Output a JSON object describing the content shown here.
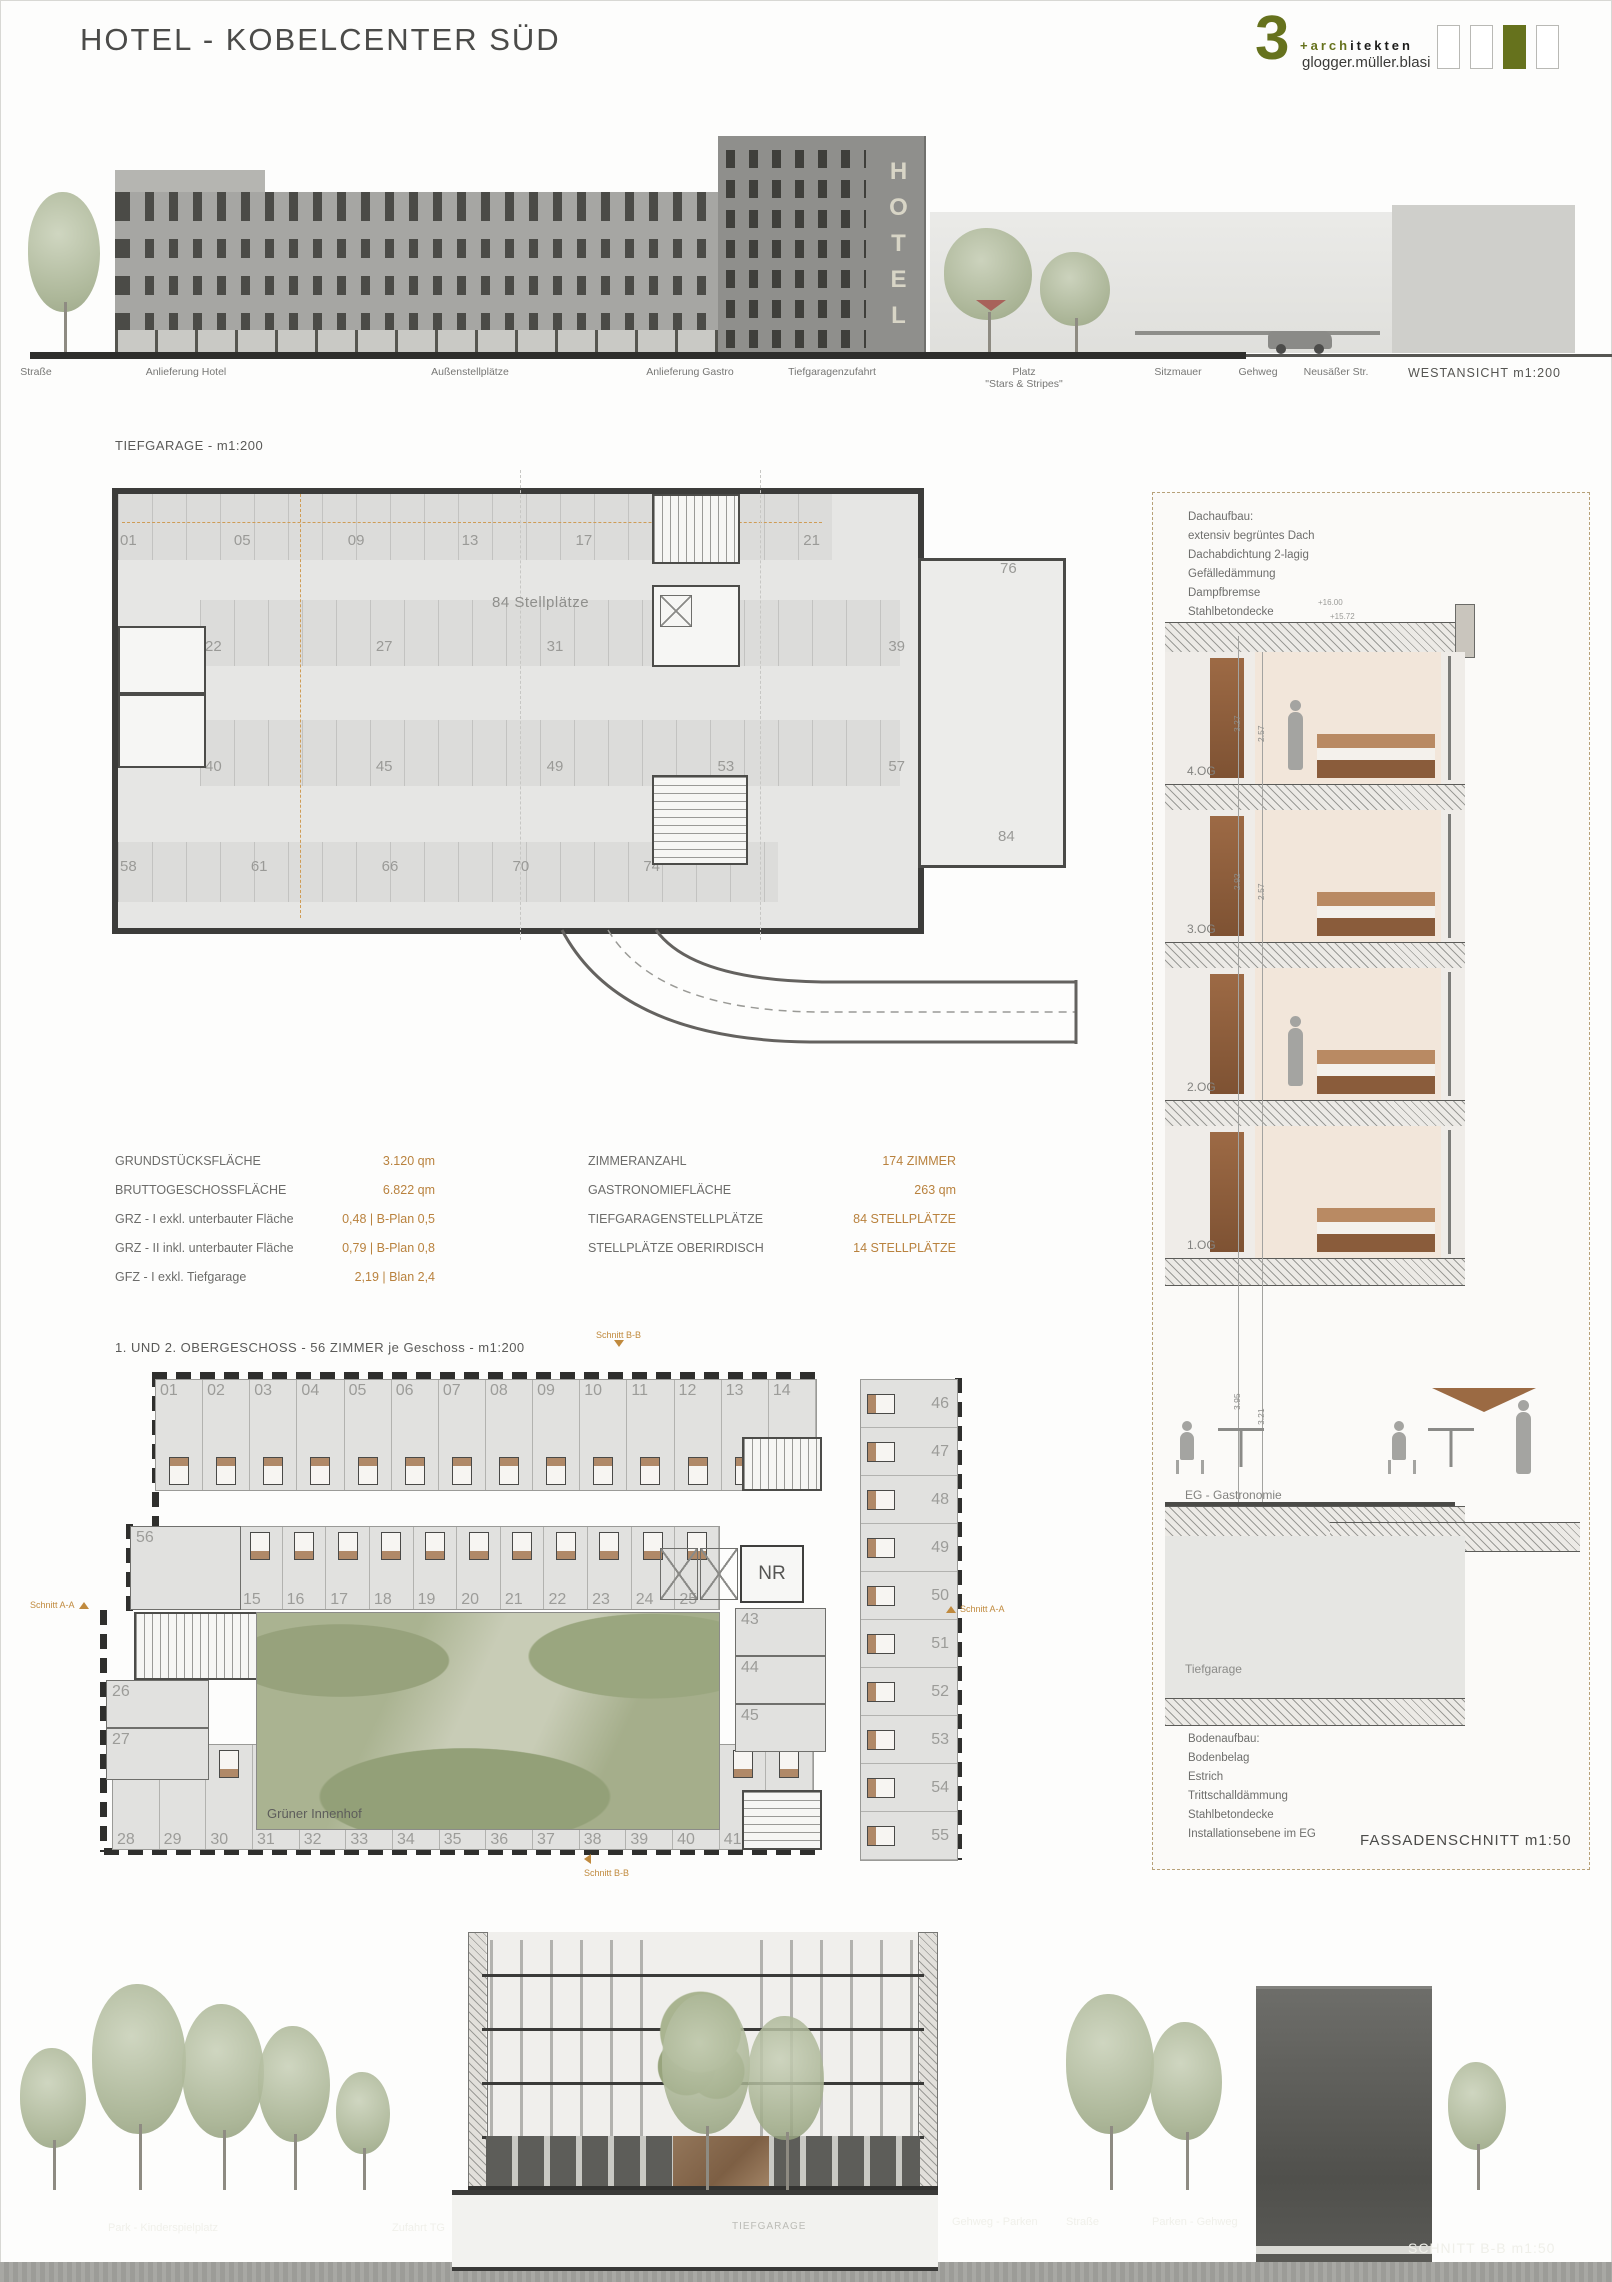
{
  "page": {
    "title": "HOTEL - KOBELCENTER SÜD"
  },
  "logo": {
    "number": "3",
    "accent": "+arch",
    "rest": "itekten",
    "subtitle": "glogger.müller.blasi",
    "olive_color": "#66721d"
  },
  "elevation": {
    "labels": [
      "Straße",
      "Anlieferung Hotel",
      "Außenstellplätze",
      "Anlieferung Gastro",
      "Tiefgaragenzufahrt",
      "Platz\n\"Stars & Stripes\"",
      "Sitzmauer",
      "Gehweg",
      "Neusäßer Str."
    ],
    "caption": "WESTANSICHT m1:200",
    "hotel_sign": "HOTEL"
  },
  "garage": {
    "title": "TIEFGARAGE - m1:200",
    "center_label": "84 Stellplätze",
    "row_top": [
      "01",
      "05",
      "09",
      "13",
      "17",
      "19",
      "21"
    ],
    "row2": [
      "22",
      "27",
      "31",
      "35",
      "39"
    ],
    "row3": [
      "40",
      "45",
      "49",
      "53",
      "57"
    ],
    "row4": [
      "58",
      "61",
      "66",
      "70",
      "74"
    ],
    "num_76": "76",
    "num_84": "84"
  },
  "stats": {
    "left": [
      {
        "label": "GRUNDSTÜCKSFLÄCHE",
        "value": "3.120 qm"
      },
      {
        "label": "BRUTTOGESCHOSSFLÄCHE",
        "value": "6.822 qm"
      },
      {
        "label": "GRZ - I exkl. unterbauter Fläche",
        "value": "0,48 | B-Plan 0,5"
      },
      {
        "label": "GRZ - II inkl. unterbauter Fläche",
        "value": "0,79 | B-Plan 0,8"
      },
      {
        "label": "GFZ - I exkl. Tiefgarage",
        "value": "2,19 | Blan 2,4"
      }
    ],
    "right": [
      {
        "label": "ZIMMERANZAHL",
        "value": "174 ZIMMER"
      },
      {
        "label": "GASTRONOMIEFLÄCHE",
        "value": "263 qm"
      },
      {
        "label": "TIEFGARAGENSTELLPLÄTZE",
        "value": "84 STELLPLÄTZE"
      },
      {
        "label": "STELLPLÄTZE OBERIRDISCH",
        "value": "14 STELLPLÄTZE"
      }
    ]
  },
  "floorplan": {
    "title": "1. UND 2. OBERGESCHOSS - 56 ZIMMER je Geschoss - m1:200",
    "courtyard_label": "Grüner Innenhof",
    "rooms_top": [
      "01",
      "02",
      "03",
      "04",
      "05",
      "06",
      "07",
      "08",
      "09",
      "10",
      "11",
      "12",
      "13",
      "14"
    ],
    "rooms_mid": [
      "15",
      "16",
      "17",
      "18",
      "19",
      "20",
      "21",
      "22",
      "23",
      "24",
      "25"
    ],
    "rooms_bottom": [
      "28",
      "29",
      "30",
      "31",
      "32",
      "33",
      "34",
      "35",
      "36",
      "37",
      "38",
      "39",
      "40",
      "41",
      "42"
    ],
    "rooms_right": [
      "46",
      "47",
      "48",
      "49",
      "50",
      "51",
      "52",
      "53",
      "54",
      "55"
    ],
    "room_56": "56",
    "room_26": "26",
    "room_27": "27",
    "room_43": "43",
    "room_44": "44",
    "room_45": "45",
    "nr_label": "NR",
    "section_bb": "Schnitt B-B",
    "section_aa": "Schnitt A-A"
  },
  "facade": {
    "roof_notes": [
      "Dachaufbau:",
      "extensiv begrüntes Dach",
      "Dachabdichtung 2-lagig",
      "Gefälledämmung",
      "Dampfbremse",
      "Stahlbetondecke"
    ],
    "floor_labels": [
      "4.OG",
      "3.OG",
      "2.OG",
      "1.OG"
    ],
    "eg_label": "EG - Gastronomie",
    "tg_label": "Tiefgarage",
    "floor_notes": [
      "Bodenaufbau:",
      "Bodenbelag",
      "Estrich",
      "Trittschalldämmung",
      "Stahlbetondecke",
      "Installationsebene im EG"
    ],
    "caption": "FASSADENSCHNITT m1:50",
    "levels": [
      "+16.00",
      "+15.72"
    ],
    "dims": [
      "3.27",
      "2.57",
      "2.92",
      "2.57",
      "3.95",
      "3.21",
      "3.25",
      "2.70",
      "2.20"
    ]
  },
  "bottom": {
    "labels": [
      "Park - Kinderspielplatz",
      "Zufahrt TG",
      "Gehweg - Parken",
      "Straße",
      "Parken - Gehweg"
    ],
    "tg_label": "TIEFGARAGE",
    "caption": "SCHNITT B-B m1:50"
  },
  "colors": {
    "accent_orange": "#c08a3e",
    "olive": "#66721d",
    "value_orange": "#b9823e"
  }
}
